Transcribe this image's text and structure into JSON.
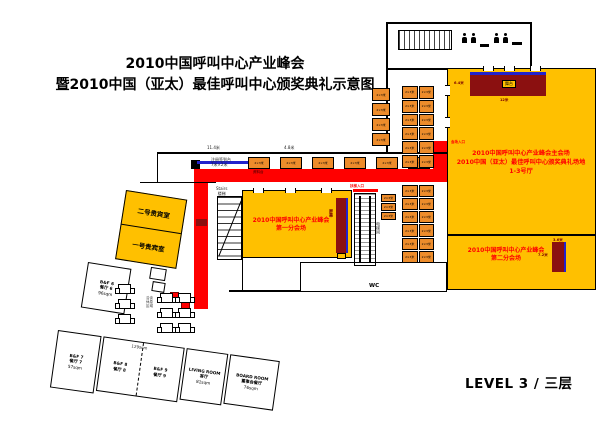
{
  "title": {
    "line1": "2010中国呼叫中心产业峰会",
    "line2": "暨2010中国（亚太）最佳呼叫中心颁奖典礼示意图"
  },
  "level_label": "LEVEL 3 / 三层",
  "colors": {
    "room_yellow": "#FFC000",
    "booth_orange": "#ED8C2B",
    "stage_dark_red": "#8B1010",
    "path_red": "#FF0000",
    "line_blue": "#2222CC"
  },
  "main_hall": {
    "line1": "2010中国呼叫中心产业峰会主会场",
    "line2": "2010中国（亚太）最佳呼叫中心颁奖典礼场地",
    "line3": "1-3号厅",
    "stage_label": "舞台",
    "entrance_label": "会场入口",
    "stage_width": "12米",
    "stage_side": "6.4米"
  },
  "hall_one": {
    "line1": "2010中国呼叫中心产业峰会",
    "line2": "第一分会场",
    "screen_label": "屏幕"
  },
  "hall_two": {
    "line1": "2010中国呼叫中心产业峰会",
    "line2": "第二分会场",
    "screen_w": "3.6米",
    "screen_h": "7.2米"
  },
  "vip_rooms": {
    "room2": "二号贵宾室",
    "room1": "一号贵宾室"
  },
  "stairs": {
    "en": "Stairs",
    "zh": "楼梯"
  },
  "booths": {
    "label": "2×3米"
  },
  "registration": {
    "desk_line1": "注册签到台",
    "desk_line2": "7米×2米",
    "materials_desk": "资料台",
    "dim_a": "11.4米",
    "dim_b": "4.8米"
  },
  "circulation": {
    "escalator_entry": "扶梯入口",
    "elevator": "电梯间",
    "wc": "WC"
  },
  "lounge": {
    "line1": "洽谈",
    "line2": "休息",
    "line3": "区域"
  },
  "rooms": {
    "bf6": {
      "en": "B&F 6",
      "zh": "餐厅 6",
      "area": "96sqm"
    },
    "bf7": {
      "en": "B&F 7",
      "zh": "餐厅 7",
      "area": "57sqm"
    },
    "bf8": {
      "en": "B&F 8",
      "zh": "餐厅 8"
    },
    "bf9": {
      "en": "B&F 9",
      "zh": "餐厅 9"
    },
    "bf89_area": "129sqm",
    "living": {
      "en": "LIVING ROOM",
      "zh": "客厅",
      "area": "81sqm"
    },
    "board": {
      "en": "BOARD ROOM",
      "zh": "董事会餐厅",
      "area": "76sqm"
    }
  },
  "floorplan": {
    "booth_groups": [
      {
        "name": "north-row",
        "x": 248,
        "y": 157,
        "w": 182,
        "h": 12,
        "cols": 6,
        "rows": 1,
        "cgap": 10,
        "rgap": 0
      },
      {
        "name": "col-a",
        "x": 372,
        "y": 88,
        "w": 18,
        "h": 58,
        "cols": 1,
        "rows": 4,
        "cgap": 1,
        "rgap": 2
      },
      {
        "name": "grid-b",
        "x": 402,
        "y": 86,
        "w": 32,
        "h": 82,
        "cols": 2,
        "rows": 6,
        "cgap": 1,
        "rgap": 1
      },
      {
        "name": "grid-c",
        "x": 402,
        "y": 185,
        "w": 32,
        "h": 78,
        "cols": 2,
        "rows": 6,
        "cgap": 1,
        "rgap": 1
      },
      {
        "name": "col-d",
        "x": 381,
        "y": 194,
        "w": 15,
        "h": 26,
        "cols": 1,
        "rows": 3,
        "cgap": 1,
        "rgap": 1
      }
    ],
    "tables": [
      {
        "x": 118,
        "y": 284
      },
      {
        "x": 118,
        "y": 299
      },
      {
        "x": 118,
        "y": 314
      },
      {
        "x": 160,
        "y": 293
      },
      {
        "x": 178,
        "y": 293
      },
      {
        "x": 160,
        "y": 308
      },
      {
        "x": 178,
        "y": 308
      },
      {
        "x": 160,
        "y": 323
      },
      {
        "x": 178,
        "y": 323
      }
    ]
  }
}
